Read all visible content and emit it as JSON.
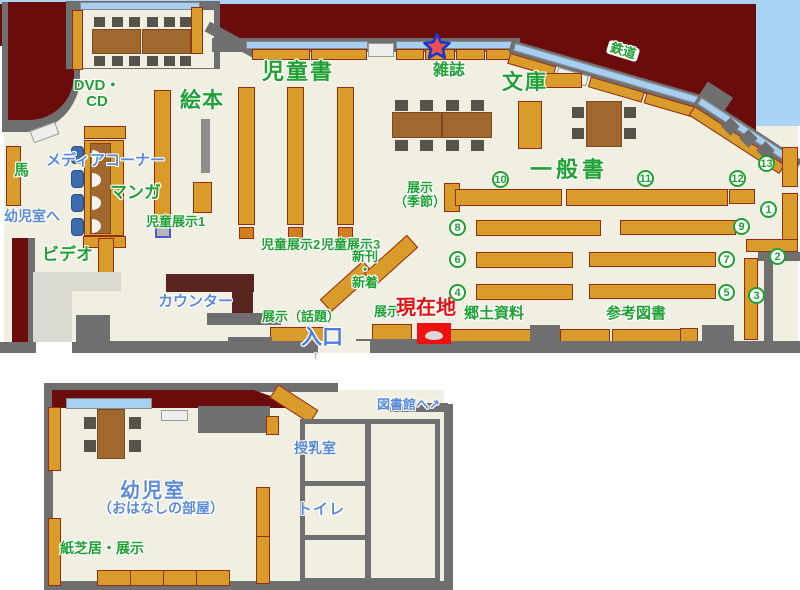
{
  "map_title": "library-floor-map",
  "colors": {
    "background_maroon": "#6b0c0c",
    "floor_cream": "#f0efe1",
    "wall_gray": "#6f6f6f",
    "shelf_tan": "#d99c2b",
    "shelf_border": "#942d16",
    "window_blue": "#a6cff2",
    "sky_blue": "#aad4f5",
    "table_brown": "#a0672f",
    "chair_gray": "#55534a",
    "chair_blue": "#3b6cab",
    "counter_dark": "#5a2421",
    "lobby_gray": "#dadad2",
    "label_green": "#21a135",
    "label_blue": "#5b8bd8",
    "label_red": "#e01212",
    "marker_red": "#ee1111",
    "star_fill": "#f05050",
    "star_outline": "#1838cc"
  },
  "labels": {
    "jidosho": "児童書",
    "zasshi": "雑誌",
    "bunko": "文庫",
    "ehon": "絵本",
    "dvd_cd": "DVD・\nCD",
    "tetsudo": "鉄道",
    "uma": "馬",
    "media_corner": "メディアコーナー",
    "manga": "マンガ",
    "yojishitsu_e": "幼児室へ",
    "video": "ビデオ",
    "counter": "カウンター",
    "jido_tenji1": "児童展示1",
    "jido_tenji2": "児童展示2",
    "jido_tenji3": "児童展示3",
    "shinkan_shincho": "新刊\n・\n新着",
    "tenji_kisetsu": "展示\n（季節）",
    "tenji_wadai": "展示（話題）",
    "tenji": "展示",
    "genzaichi": "現在地",
    "iriguchi": "入口",
    "iriguchi_arrow": "↑",
    "kyodo_shiryo": "郷土資料",
    "sanko_tosho": "参考図書",
    "ippansho": "一般書",
    "toshokan_e": "図書館へ",
    "toshokan_arrow": "↗",
    "junyushitsu": "授乳室",
    "toire": "トイレ",
    "yojishitsu": "幼児室",
    "ohanashi_heya": "（おはなしの部屋）",
    "kamishibai_tenji": "紙芝居・展示"
  },
  "numbers": [
    "1",
    "2",
    "3",
    "4",
    "5",
    "6",
    "7",
    "8",
    "9",
    "10",
    "11",
    "12",
    "13"
  ]
}
